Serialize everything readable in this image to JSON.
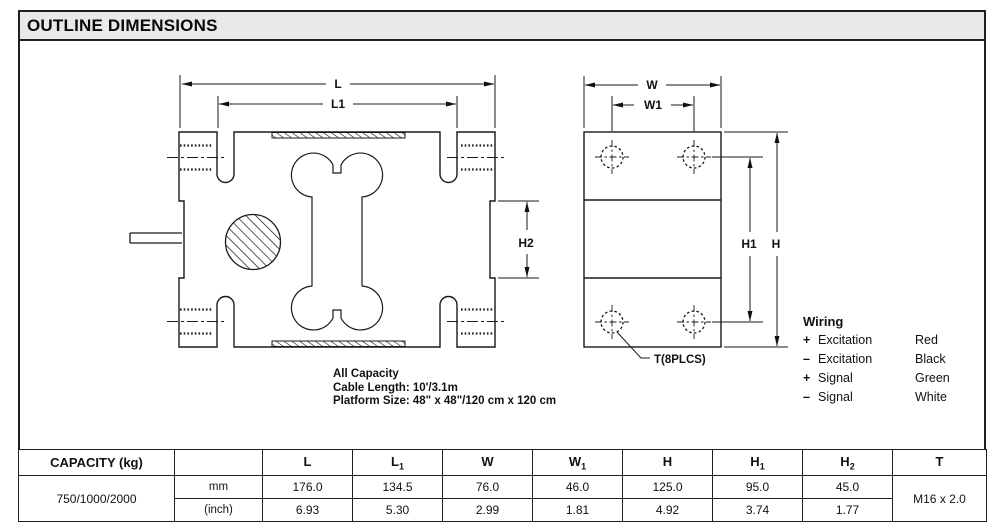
{
  "title": "OUTLINE DIMENSIONS",
  "drawing": {
    "dim_labels": {
      "l": "L",
      "l1": "L1",
      "w": "W",
      "w1": "W1",
      "h": "H",
      "h1": "H1",
      "h2": "H2"
    },
    "thread_callout": "T(8PLCS)",
    "notes": {
      "line1": "All Capacity",
      "line2": "Cable Length: 10'/3.1m",
      "line3": "Platform Size: 48\" x 48\"/120 cm x 120 cm"
    },
    "wiring": {
      "title": "Wiring",
      "rows": [
        {
          "sign": "+",
          "name": "Excitation",
          "color": "Red"
        },
        {
          "sign": "–",
          "name": "Excitation",
          "color": "Black"
        },
        {
          "sign": "+",
          "name": "Signal",
          "color": "Green"
        },
        {
          "sign": "–",
          "name": "Signal",
          "color": "White"
        }
      ]
    }
  },
  "table": {
    "capacity_header": "CAPACITY (kg)",
    "columns": [
      {
        "main": "L",
        "sub": ""
      },
      {
        "main": "L",
        "sub": "1"
      },
      {
        "main": "W",
        "sub": ""
      },
      {
        "main": "W",
        "sub": "1"
      },
      {
        "main": "H",
        "sub": ""
      },
      {
        "main": "H",
        "sub": "1"
      },
      {
        "main": "H",
        "sub": "2"
      },
      {
        "main": "T",
        "sub": ""
      }
    ],
    "capacity_value": "750/1000/2000",
    "rows": [
      {
        "unit": "mm",
        "values": [
          "176.0",
          "134.5",
          "76.0",
          "46.0",
          "125.0",
          "95.0",
          "45.0"
        ]
      },
      {
        "unit": "(inch)",
        "values": [
          "6.93",
          "5.30",
          "2.99",
          "1.81",
          "4.92",
          "3.74",
          "1.77"
        ]
      }
    ],
    "thread_value": "M16 x 2.0"
  }
}
